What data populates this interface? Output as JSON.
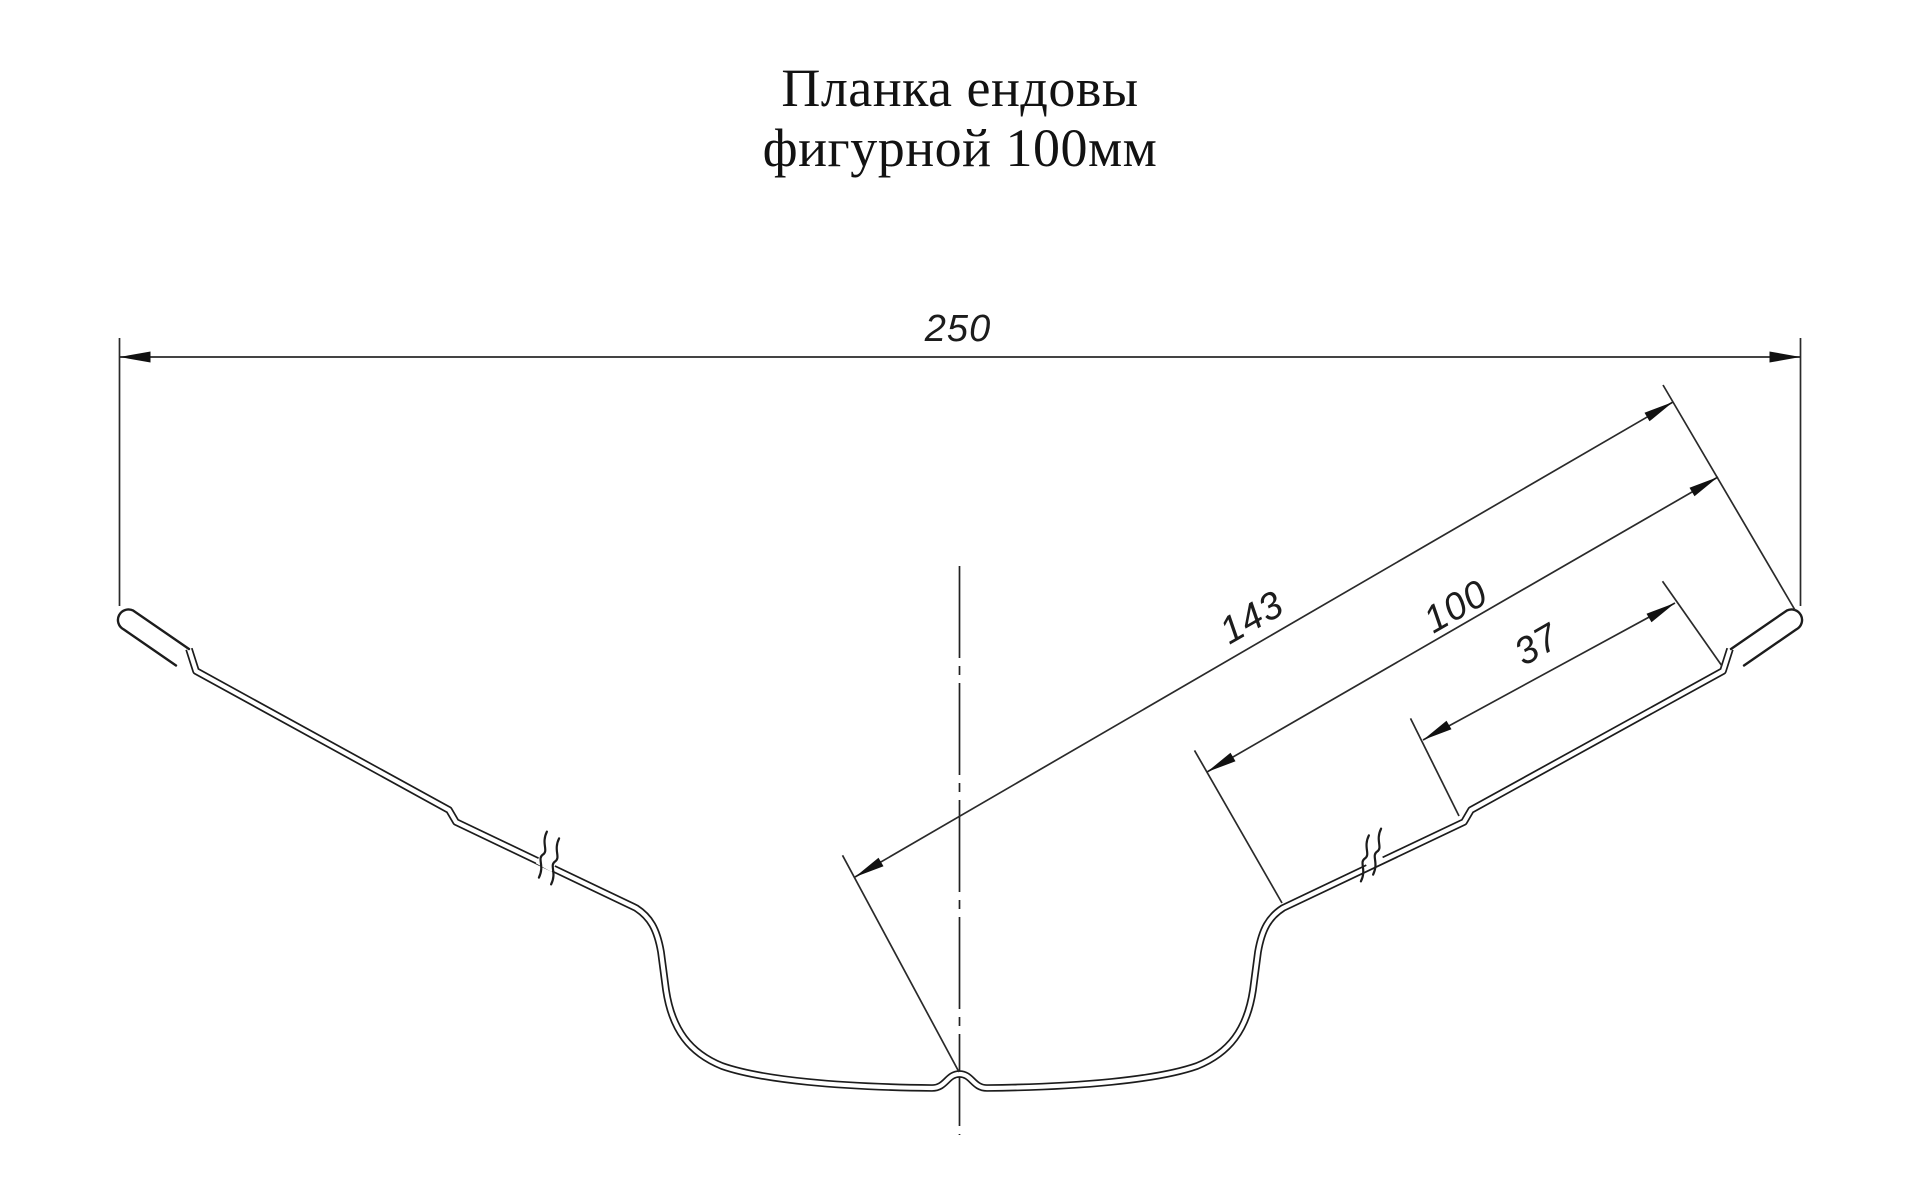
{
  "drawing": {
    "title_line1": "Планка ендовы",
    "title_line2": "фигурной 100мм",
    "line_color": "#1c1c1c",
    "background_color": "#ffffff"
  },
  "dimensions": {
    "overall_width": "250",
    "half_profile_length": "143",
    "flange_length": "100",
    "edge_step_length": "37"
  }
}
